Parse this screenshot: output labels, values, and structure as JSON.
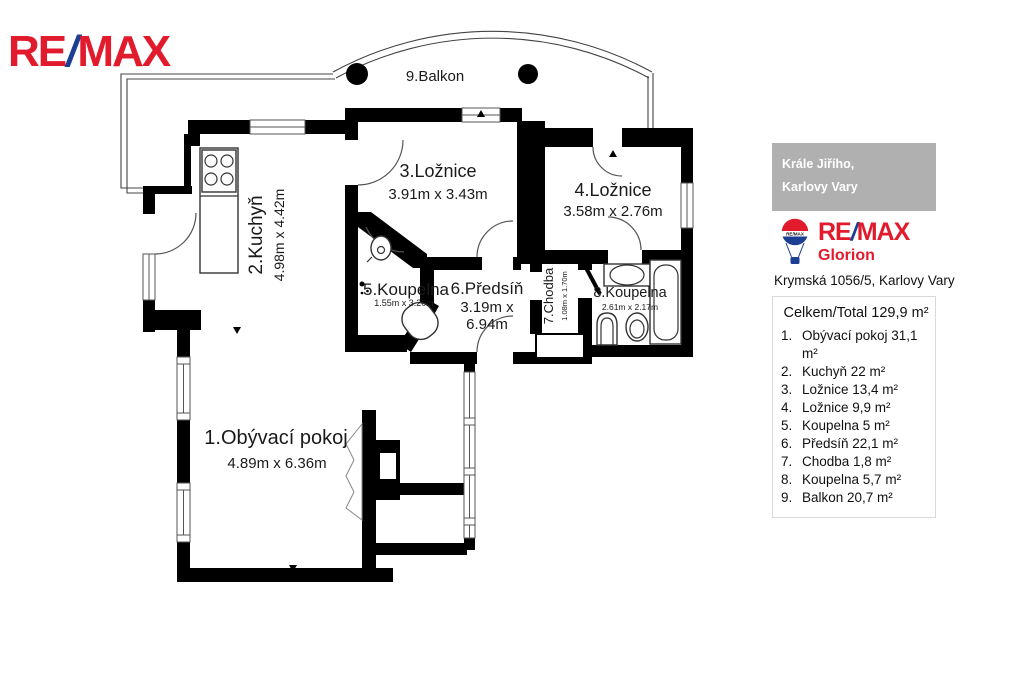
{
  "brand": {
    "re": "RE",
    "slash": "/",
    "max": "MAX",
    "red": "#e11a2c",
    "blue": "#1c3f94"
  },
  "floorplan": {
    "balcony_label": "9.Balkon",
    "rooms": [
      {
        "name": "1.Obývací pokoj",
        "dims": "4.89m x 6.36m"
      },
      {
        "name": "2.Kuchyň",
        "dims": "4.98m x 4.42m"
      },
      {
        "name": "3.Ložnice",
        "dims": "3.91m x 3.43m"
      },
      {
        "name": "4.Ložnice",
        "dims": "3.58m x 2.76m"
      },
      {
        "name": "5.Koupelna",
        "dims": "1.55m x 3.20m"
      },
      {
        "name": "6.Předsíň",
        "dims_line1": "3.19m x",
        "dims_line2": "6.94m"
      },
      {
        "name": "7.Chodba",
        "dims": "1.08m x 1.70m"
      },
      {
        "name": "8.Koupelna",
        "dims": "2.61m x 2.17m"
      }
    ]
  },
  "panel": {
    "location_line1": "Krále Jiřího,",
    "location_line2": "Karlovy Vary",
    "agency_name": "Glorion",
    "address": "Krymská 1056/5, Karlovy Vary",
    "total": "Celkem/Total 129,9  m²",
    "rooms": [
      {
        "num": "1.",
        "text": "Obývací pokoj 31,1 m²"
      },
      {
        "num": "2.",
        "text": "Kuchyň 22 m²"
      },
      {
        "num": "3.",
        "text": "Ložnice 13,4 m²"
      },
      {
        "num": "4.",
        "text": "Ložnice 9,9 m²"
      },
      {
        "num": "5.",
        "text": "Koupelna 5 m²"
      },
      {
        "num": "6.",
        "text": "Předsíň 22,1 m²"
      },
      {
        "num": "7.",
        "text": "Chodba 1,8 m²"
      },
      {
        "num": "8.",
        "text": "Koupelna 5,7 m²"
      },
      {
        "num": "9.",
        "text": "Balkon 20,7 m²"
      }
    ]
  }
}
